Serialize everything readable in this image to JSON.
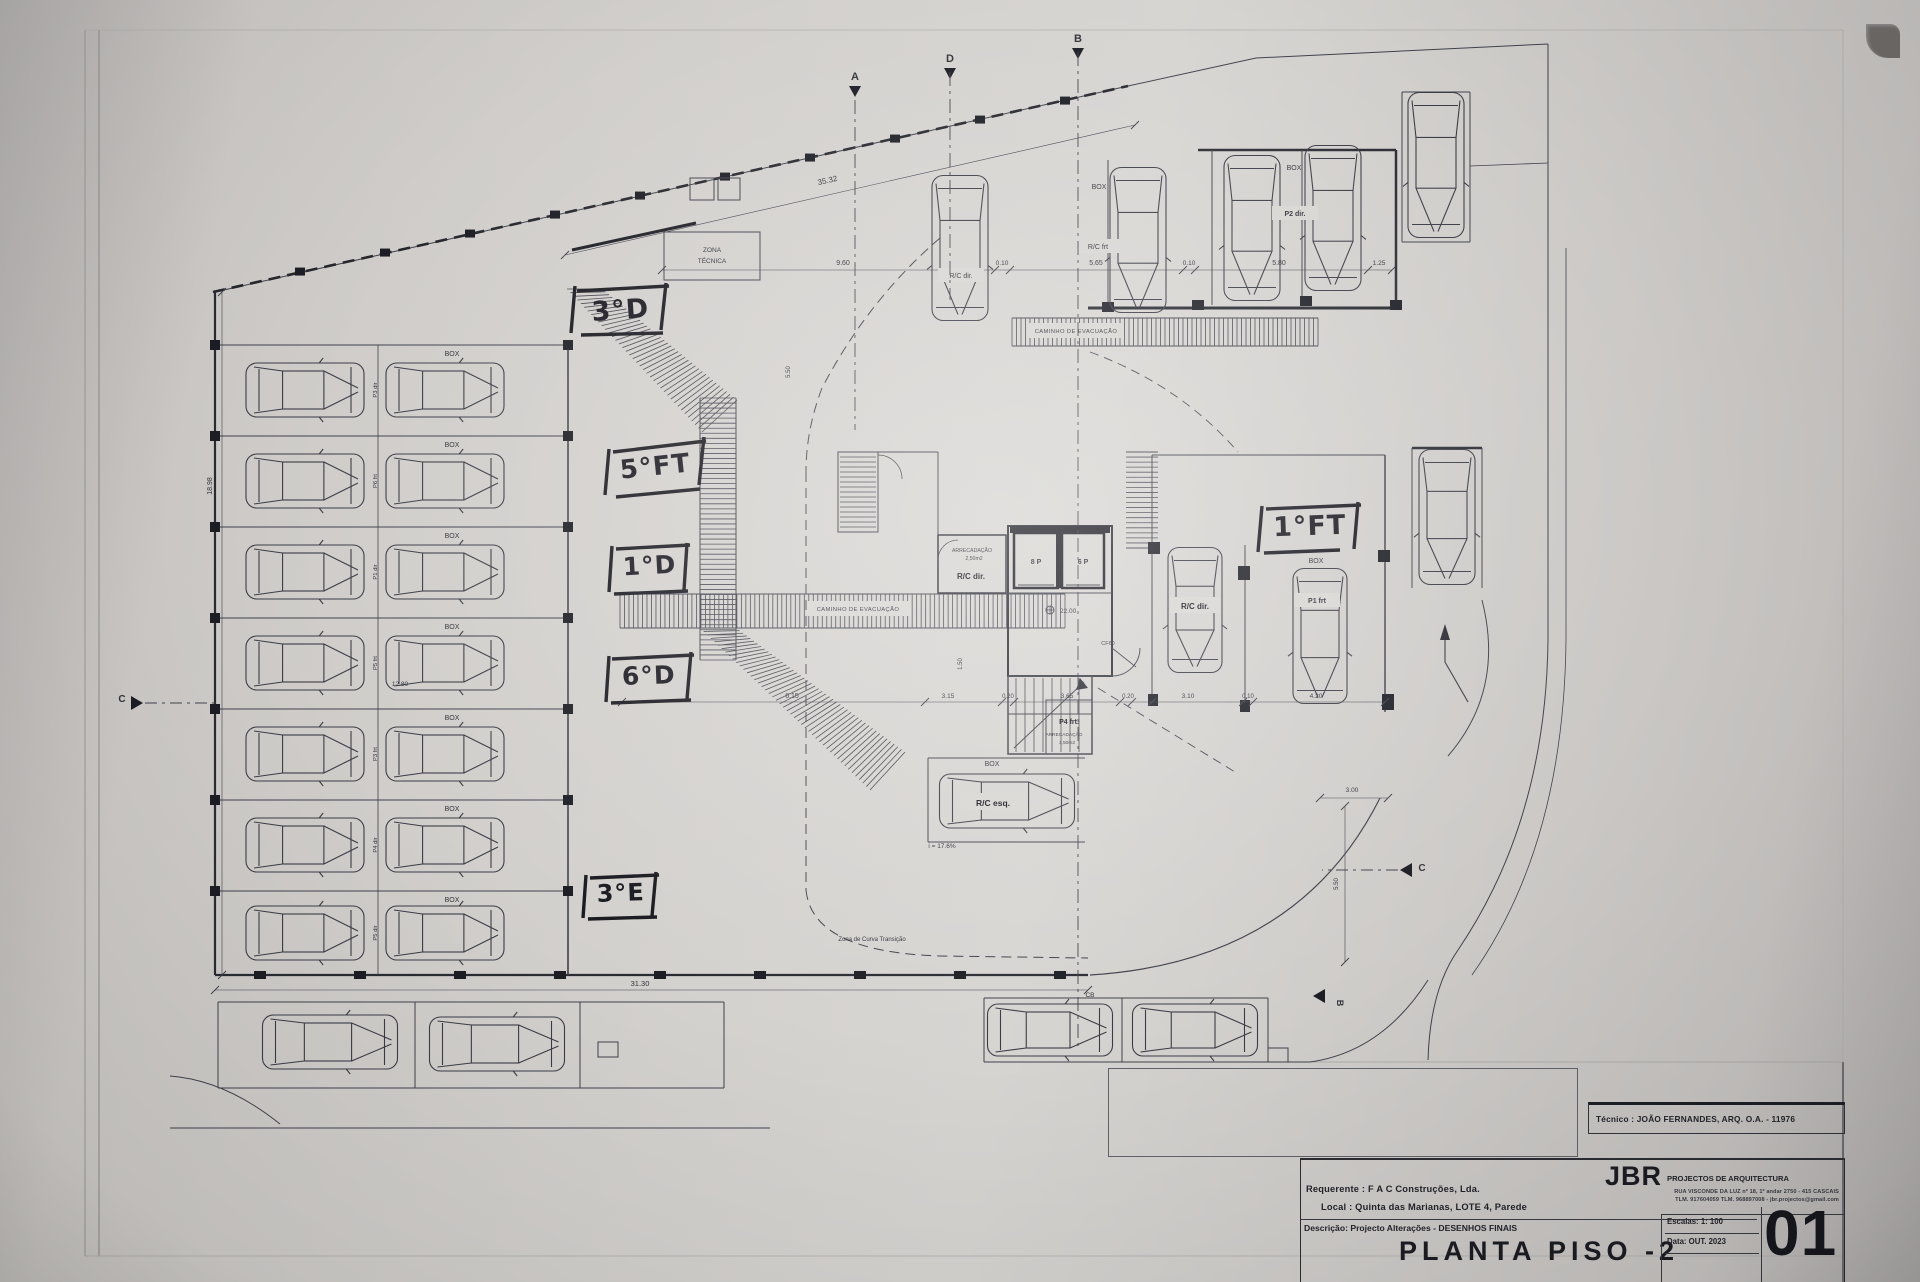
{
  "labels": {
    "box": "BOX",
    "zona1": "ZONA",
    "zona2": "TÉCNICA",
    "caminho": "CAMINHO DE EVACUAÇÃO",
    "zona_curva": "Zona de Curva Transição",
    "slope": "i = 17.6%",
    "cf60": "CF60",
    "level": "22.00",
    "elev8": "8 P",
    "elev6": "6 P",
    "arrec": "ARRECADAÇÃO",
    "a250": "2,50m2",
    "a350": "3,50m2",
    "rc_frt": "R/C frt",
    "rc_dir": "R/C dir.",
    "rc_esq": "R/C esq.",
    "p1_frt": "P1 frt",
    "p2_dir": "P2 dir.",
    "p4_frt": "P4 frt."
  },
  "rows": [
    {
      "p": "P3 dir"
    },
    {
      "p": "P6 frt"
    },
    {
      "p": "P1 dir"
    },
    {
      "p": "P5 frt"
    },
    {
      "p": "P3 frt"
    },
    {
      "p": "P4 dir"
    },
    {
      "p": "P5 dir"
    }
  ],
  "hand": [
    "3°D",
    "5°FT",
    "1°D",
    "6°D",
    "3°E",
    "1°FT"
  ],
  "dims": {
    "top": "35.32",
    "bottom": "31.30",
    "left": "18.98",
    "a": "9.60",
    "b": "0.10",
    "c": "5.65",
    "d": "5.80",
    "e": "1.25",
    "f": "6.15",
    "g": "3.15",
    "h": "0.20",
    "i": "3.65",
    "j": "3.10",
    "k": "4.20",
    "l": "1.50",
    "m": "5.50",
    "n": "3.00",
    "o": "12.80"
  },
  "sections": {
    "a": "A",
    "b": "B",
    "c": "C",
    "d": "D",
    "cb": "CB"
  },
  "title_block": {
    "tecnico": "Técnico : JOÃO FERNANDES, ARQ.   O.A. - 11976",
    "firm": "JBR",
    "firm_desc": "PROJECTOS DE ARQUITECTURA",
    "address1": "RUA VISCONDE DA LUZ nº 18, 1º andar  2750 - 415  CASCAIS",
    "address2": "TLM. 917604059  TLM. 968897008 - jbr.projectos@gmail.com",
    "requerente_label": "Requerente :",
    "requerente": "F A C  Construções, Lda.",
    "local_label": "Local :",
    "local": "Quinta das Marianas, LOTE 4, Parede",
    "descricao_label": "Descrição:",
    "descricao": "Projecto Alterações - DESENHOS FINAIS",
    "title": "PLANTA PISO -2",
    "escala_label": "Escalas:",
    "escala": "1: 100",
    "data_label": "Data:",
    "data": "OUT. 2023",
    "sheet": "01"
  }
}
